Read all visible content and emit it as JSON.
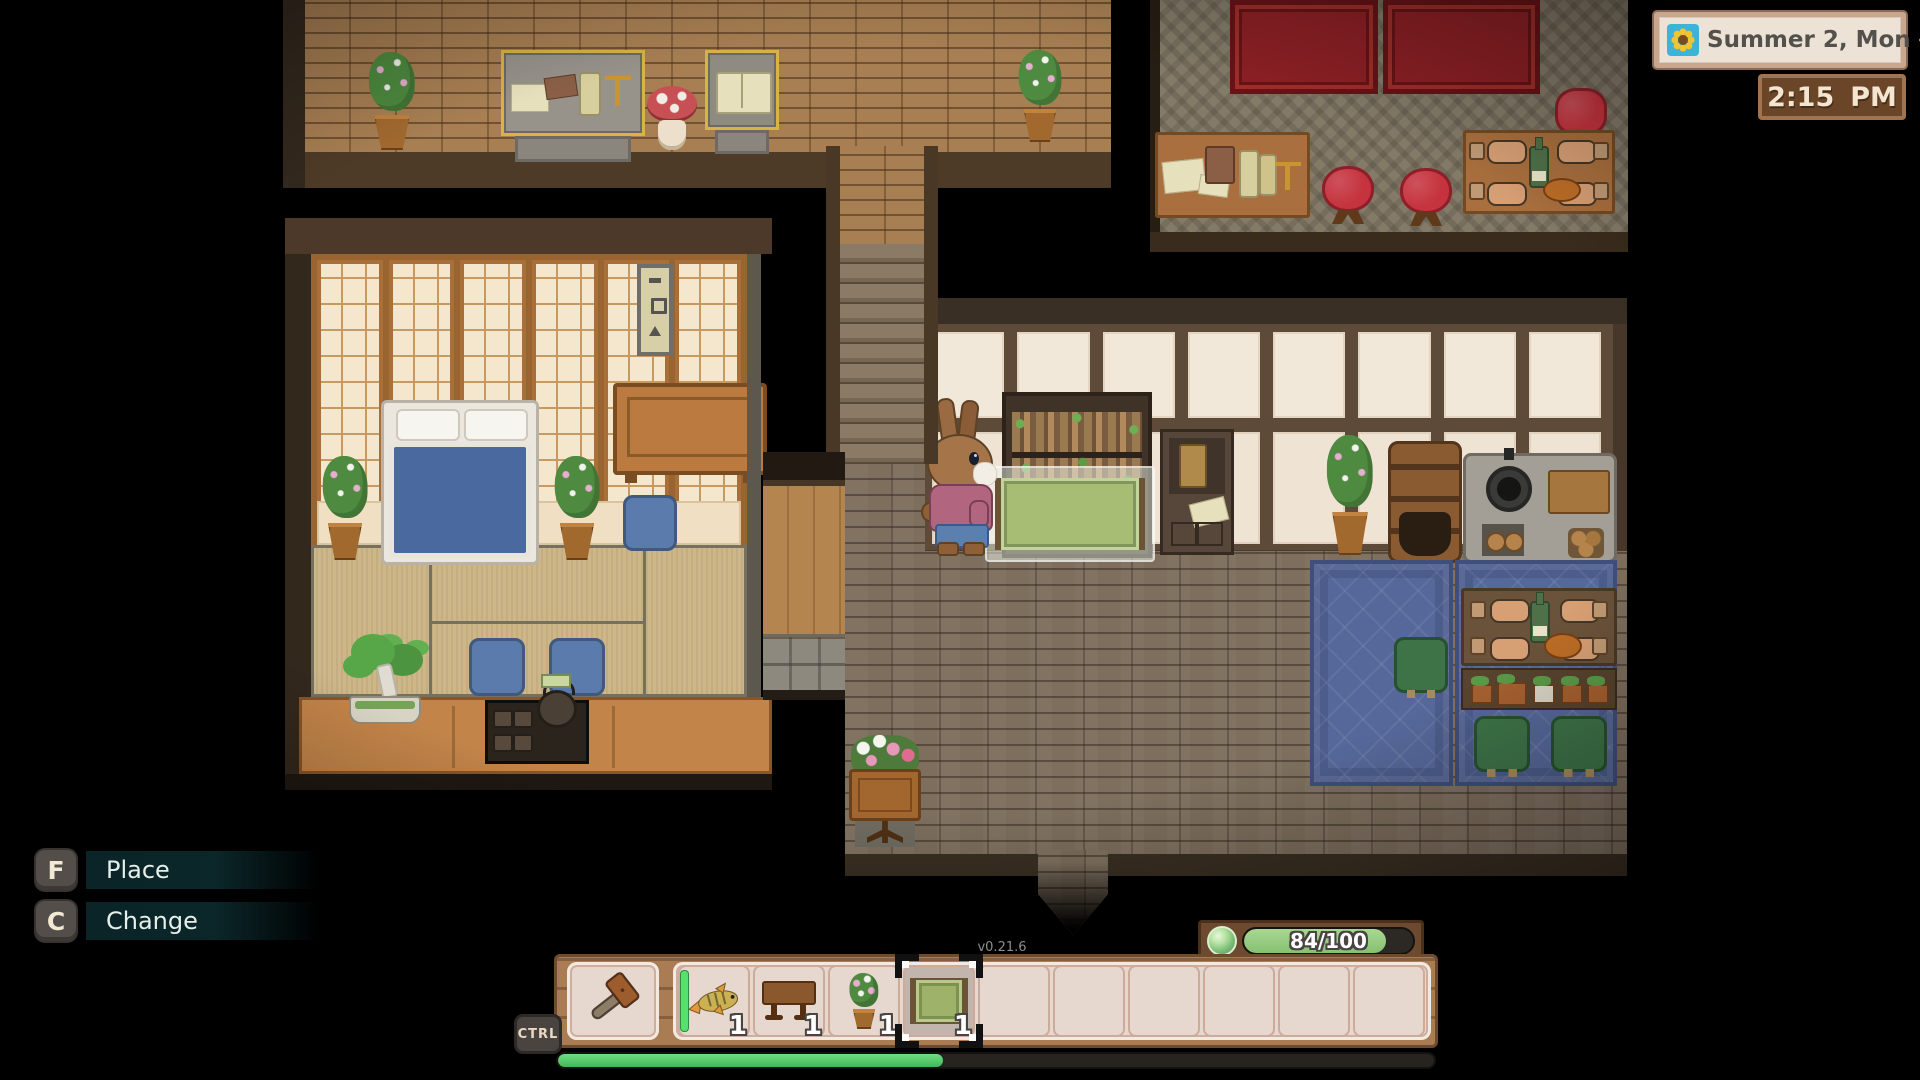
{
  "hud": {
    "date_widget": {
      "date": "Summer 2, Mon",
      "season_icon": "sunflower-icon",
      "weather_icon": "sun-icon"
    },
    "time_widget": {
      "time": "2:15",
      "meridiem": "PM"
    },
    "keybinds": [
      {
        "key": "F",
        "action": "Place"
      },
      {
        "key": "C",
        "action": "Change"
      }
    ],
    "modifier_key": "CTRL",
    "version": "v0.21.6",
    "energy": {
      "icon": "energy-orb-icon",
      "current": 84,
      "max": 100,
      "label": "84/100",
      "percent": 84
    },
    "hotbar": {
      "tool_slot": {
        "item": "hammer"
      },
      "progress_percent": 44,
      "slots": [
        {
          "item": "fish",
          "quantity": 1,
          "fresh": true
        },
        {
          "item": "wooden-table",
          "quantity": 1
        },
        {
          "item": "potted-plant",
          "quantity": 1
        },
        {
          "item": "green-rug",
          "quantity": 1,
          "selected": true
        },
        {},
        {},
        {},
        {},
        {},
        {}
      ]
    }
  },
  "scene": {
    "character": "rabbit-villager",
    "placement_preview_item": "green-rug",
    "rooms": [
      "museum-gallery",
      "lounge",
      "tatami-bedroom",
      "main-hall"
    ]
  },
  "colors": {
    "progress_green": "#4cc763",
    "energy_green": "#8fc878",
    "hud_wood": "#a97c54",
    "carpet_red": "#8c2025",
    "rug_blue": "#56689a"
  }
}
